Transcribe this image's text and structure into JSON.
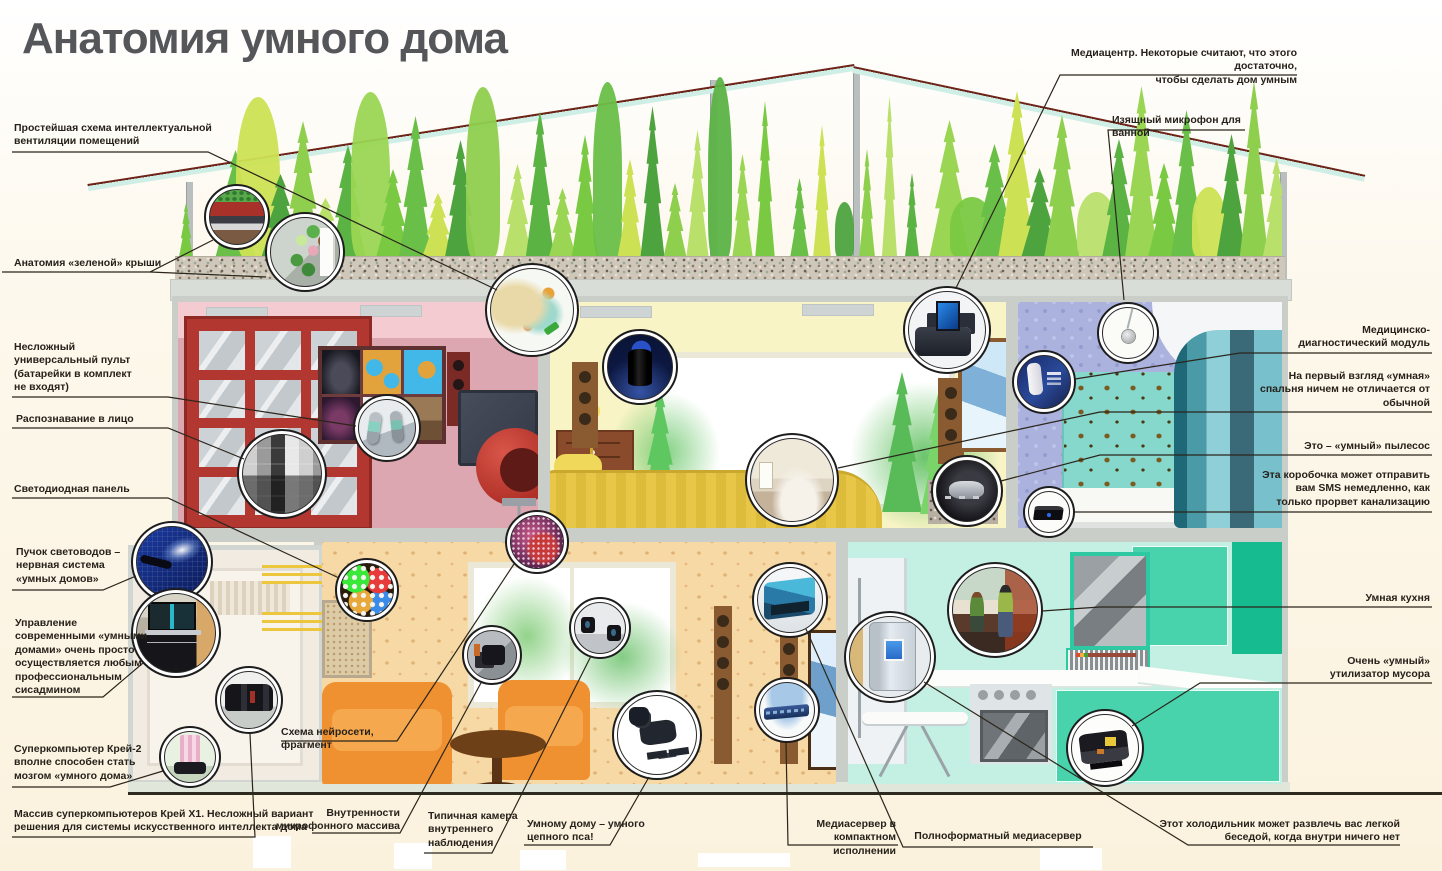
{
  "title": "Анатомия умного дома",
  "palette": {
    "roof_beam": "#cfeee6",
    "roof_edge": "#6e2418",
    "wall_media_room": "#dca7b1",
    "wall_living_room": "#f8f4c6",
    "wall_bathroom": "#aab2dd",
    "wall_lounge": "#f7d9a6",
    "wall_kitchen": "#c4efe3",
    "door_red": "#b23730",
    "ground_line": "#2e2a20",
    "background_cream": "#fbf2de",
    "callout_line": "#2b251b",
    "title_color": "#55565a"
  },
  "callouts": {
    "ventilation": "Простейшая схема интеллектуальной\nвентиляции помещений",
    "green_roof": "Анатомия «зеленой» крыши",
    "remote": "Несложный\nуниверсальный пульт\n(батарейки в комплект\nне входят)",
    "face_recognition": "Распознавание в лицо",
    "led_panel": "Светодиодная панель",
    "fiber": "Пучок световодов –\nнервная система\n«умных домов»",
    "sysadmin": "Управление\nсовременными «умными\nдомами» очень просто\nосуществляется любым\nпрофессиональным\nсисадмином",
    "cray2": "Суперкомпьютер Крей-2\nвполне способен стать\nмозгом «умного дома»",
    "crayx1": "Массив суперкомпьютеров Крей Х1. Несложный вариант\nрешения для системы искусственного интеллекта дома",
    "neural": "Схема нейросети, фрагмент",
    "mic_array": "Внутренности\nмикрофонного массива",
    "camera": "Типичная камера\nвнутреннего\nнаблюдения",
    "robodog": "Умному дому – умного\nцепного пса!",
    "compact_server": "Медиасервер в компактном\nисполнении",
    "full_server": "Полноформатный медиасервер",
    "fridge": "Этот холодильник может развлечь вас легкой\nбеседой, когда внутри ничего нет",
    "mediacenter": "Медиацентр. Некоторые считают, что этого достаточно,\nчтобы сделать дом умным",
    "bath_mic": "Изящный микрофон для ванной",
    "med_module": "Медицинско-\nдиагностический модуль",
    "bedroom": "На первый взгляд «умная»\nспальня ничем не отличается от\nобычной",
    "vacuum": "Это – «умный» пылесос",
    "sms_box": "Эта коробочка может отправить\nвам SMS немедленно, как\nтолько прорвет канализацию",
    "kitchen": "Умная кухня",
    "trash": "Очень «умный»\nутилизатор мусора"
  },
  "insets": [
    "green-roof-layers-photo",
    "green-roof-modules-photo",
    "ventilation-scheme-photo",
    "smart-speaker-photo",
    "universal-remote-photo",
    "face-recognition-photo",
    "bedroom-photo",
    "media-center-photo",
    "bathroom-microphone-photo",
    "medical-module-photo",
    "robot-vacuum-photo",
    "sms-box-photo",
    "fiber-optics-photo",
    "sysadmin-desk-photo",
    "cray-x1-array-photo",
    "cray-2-photo",
    "led-panel-photo",
    "neural-net-photo",
    "microphone-array-photo",
    "surveillance-camera-photo",
    "full-media-server-photo",
    "compact-media-server-photo",
    "robot-dog-photo",
    "smart-fridge-photo",
    "smart-kitchen-photo",
    "trash-utilizer-photo"
  ]
}
